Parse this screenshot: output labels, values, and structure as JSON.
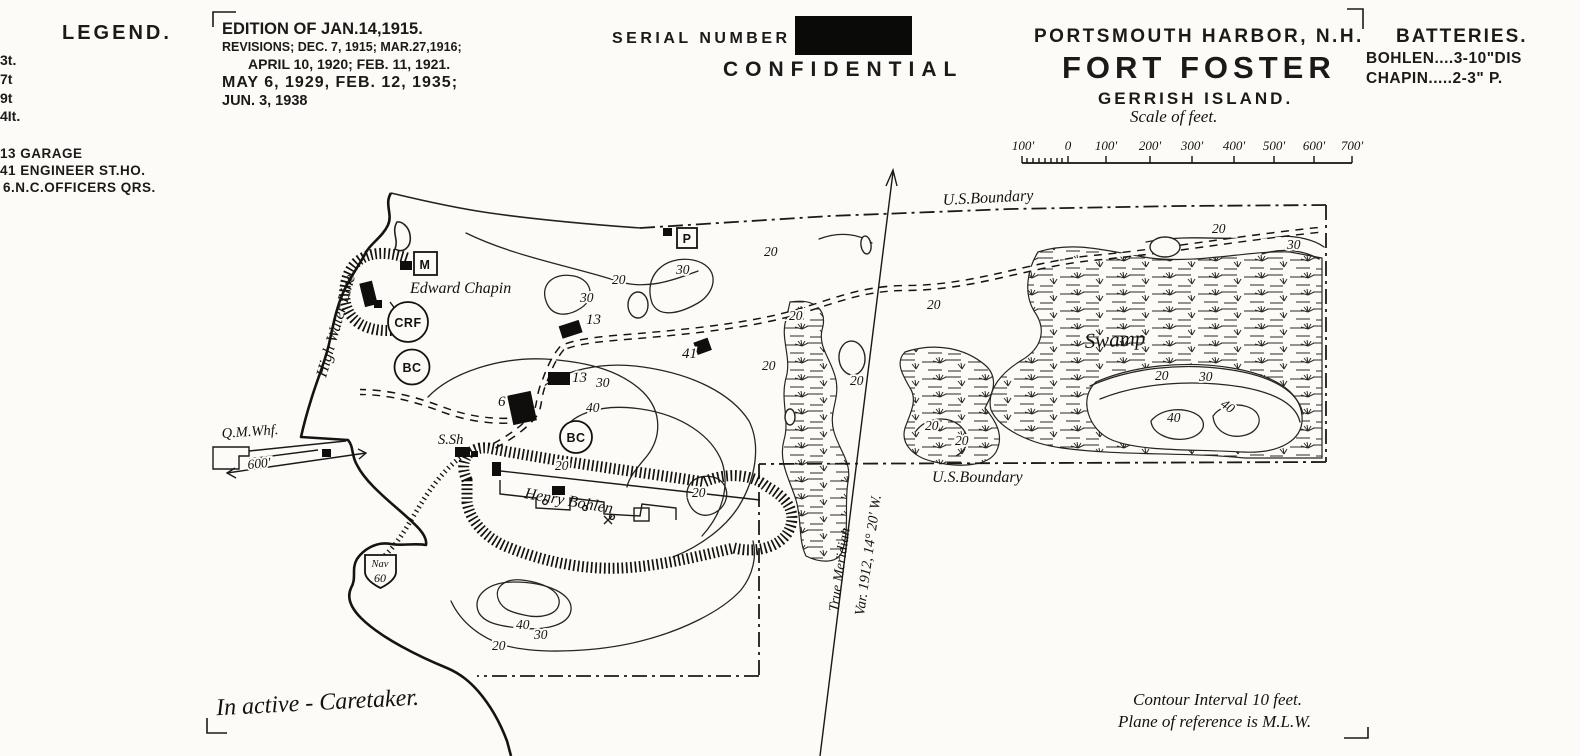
{
  "header": {
    "legend_title": "LEGEND.",
    "legend_partials": [
      "3t.",
      "7t",
      "9t",
      "4It."
    ],
    "legend_items": [
      "13 GARAGE",
      "41 ENGINEER ST.HO.",
      "6.N.C.OFFICERS QRS."
    ],
    "edition_lines": [
      "EDITION OF JAN.14,1915.",
      "REVISIONS; DEC. 7, 1915; MAR.27,1916;",
      "APRIL 10, 1920; FEB. 11, 1921.",
      "MAY 6, 1929,  FEB. 12, 1935;",
      "JUN. 3, 1938"
    ],
    "serial_label": "SERIAL NUMBER",
    "confidential": "CONFIDENTIAL",
    "harbor": "PORTSMOUTH HARBOR, N.H.",
    "fort": "FORT FOSTER",
    "island": "GERRISH ISLAND.",
    "scale_caption": "Scale of feet.",
    "scale_ticks": [
      "100'",
      "0",
      "100'",
      "200'",
      "300'",
      "400'",
      "500'",
      "600'",
      "700'"
    ],
    "batteries_title": "BATTERIES.",
    "battery_rows": [
      {
        "name": "BOHLEN",
        "dots": "....",
        "value": "3-10\"DIS"
      },
      {
        "name": "CHAPIN",
        "dots": ".....",
        "value": "2-3\" P."
      }
    ]
  },
  "map": {
    "boundary_label_top": "U.S.Boundary",
    "boundary_label_mid": "U.S.Boundary",
    "swamp_label": "Swamp",
    "high_water_line": "High Water Line",
    "true_meridian_line1": "True Meridian",
    "true_meridian_line2": "Var. 1912, 14° 20' W.",
    "battery_chapin_label": "Edward Chapin",
    "battery_bohlen_label": "Henry Bohlen",
    "crf_label": "CRF",
    "bc_label_1": "BC",
    "bc_label_2": "BC",
    "mine_marker": "M",
    "p_marker": "P",
    "qm_wharf": "Q.M.Whf.",
    "wharf_dist": "600'",
    "s_sh": "S.Sh",
    "nav_top": "Nav",
    "nav_bottom": "60",
    "building_labels": [
      "13",
      "13",
      "6",
      "41"
    ],
    "contour_labels": [
      "20",
      "30",
      "30",
      "20",
      "30",
      "40",
      "20",
      "20",
      "20",
      "20",
      "20",
      "20",
      "20",
      "20",
      "20",
      "30",
      "20",
      "30",
      "40",
      "40",
      "40",
      "30",
      "20"
    ],
    "notes": {
      "inactive": "In active - Caretaker.",
      "contour_interval": "Contour Interval 10 feet.",
      "plane_ref": "Plane of reference is M.L.W."
    }
  }
}
